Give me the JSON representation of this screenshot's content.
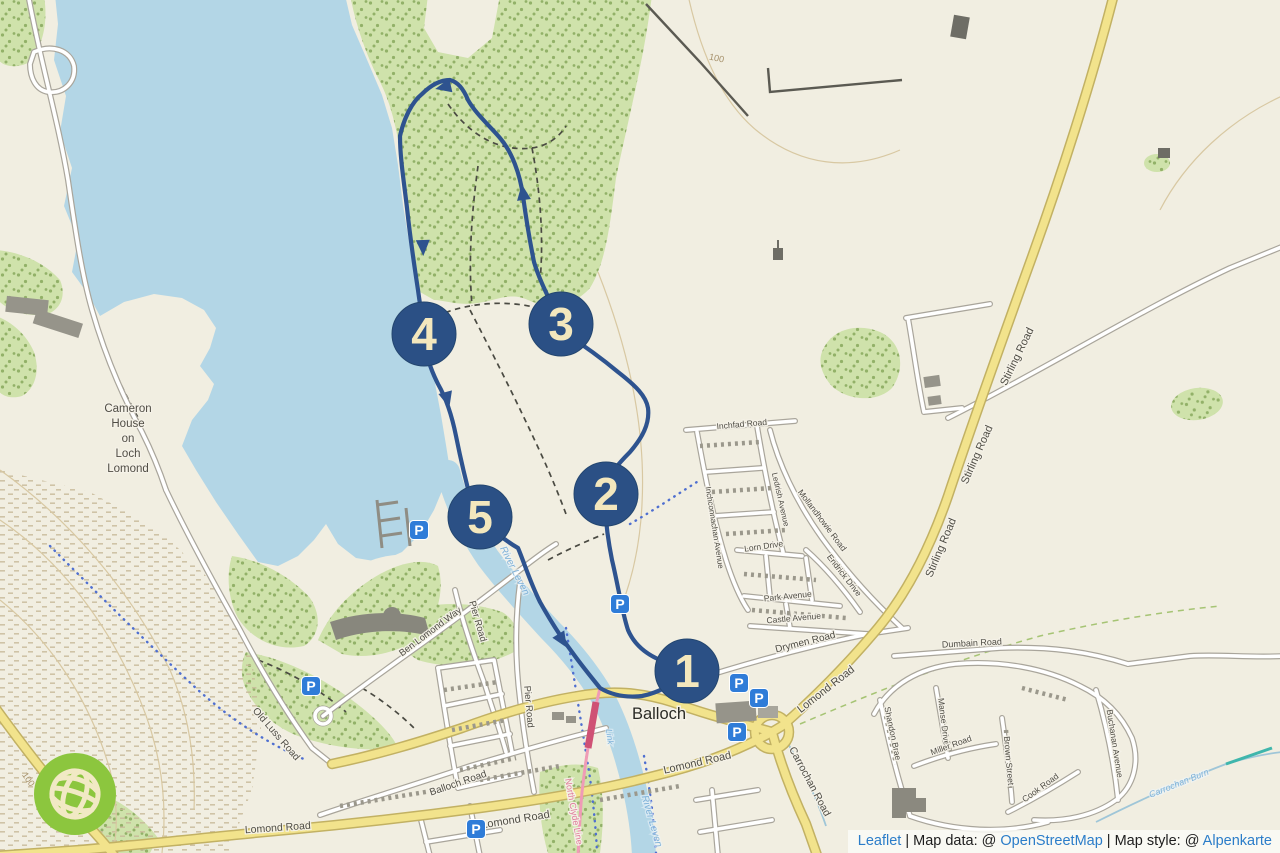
{
  "attribution": {
    "leaflet": "Leaflet",
    "sep1": " | Map data: @ ",
    "osm": "OpenStreetMap",
    "sep2": " | Map style: @ ",
    "style_name": "Alpenkarte"
  },
  "map": {
    "parking_letter": "P",
    "cameron_lines": [
      "Cameron",
      "House",
      "on",
      "Loch",
      "Lomond"
    ],
    "markers": [
      {
        "n": "1",
        "x": 687,
        "y": 671
      },
      {
        "n": "2",
        "x": 606,
        "y": 494
      },
      {
        "n": "3",
        "x": 561,
        "y": 324
      },
      {
        "n": "4",
        "x": 424,
        "y": 334
      },
      {
        "n": "5",
        "x": 480,
        "y": 517
      }
    ],
    "parking": [
      {
        "x": 419,
        "y": 530
      },
      {
        "x": 311,
        "y": 686
      },
      {
        "x": 476,
        "y": 829
      },
      {
        "x": 739,
        "y": 683
      },
      {
        "x": 759,
        "y": 698
      },
      {
        "x": 737,
        "y": 732
      },
      {
        "x": 620,
        "y": 604
      }
    ],
    "labels": [
      {
        "id": "balloch-town",
        "text": "Balloch",
        "x": 659,
        "y": 719,
        "rot": 0,
        "size": 16.5,
        "cls": "town"
      },
      {
        "id": "stirling-road-1",
        "text": "Stirling Road",
        "x": 1020,
        "y": 358,
        "rot": -64,
        "size": 11,
        "cls": "road"
      },
      {
        "id": "stirling-road-2",
        "text": "Stirling Road",
        "x": 980,
        "y": 456,
        "rot": -66,
        "size": 11,
        "cls": "road"
      },
      {
        "id": "stirling-road-3",
        "text": "Stirling Road",
        "x": 944,
        "y": 549,
        "rot": -67,
        "size": 11,
        "cls": "road"
      },
      {
        "id": "lomond-road-ne",
        "text": "Lomond Road",
        "x": 828,
        "y": 692,
        "rot": -38,
        "size": 11,
        "cls": "road"
      },
      {
        "id": "lomond-road-mid",
        "text": "Lomond Road",
        "x": 698,
        "y": 766,
        "rot": -13,
        "size": 11,
        "cls": "road"
      },
      {
        "id": "lomond-road-s",
        "text": "Lomond Road",
        "x": 516,
        "y": 823,
        "rot": -9,
        "size": 11,
        "cls": "road"
      },
      {
        "id": "lomond-road-sw",
        "text": "Lomond Road",
        "x": 278,
        "y": 831,
        "rot": -4,
        "size": 10.5,
        "cls": "road"
      },
      {
        "id": "drymen-road",
        "text": "Drymen Road",
        "x": 806,
        "y": 645,
        "rot": -14,
        "size": 10,
        "cls": "road"
      },
      {
        "id": "carrochan-road",
        "text": "Carrochan Road",
        "x": 807,
        "y": 783,
        "rot": 62,
        "size": 10.5,
        "cls": "road"
      },
      {
        "id": "balloch-road",
        "text": "Balloch Road",
        "x": 459,
        "y": 786,
        "rot": -19,
        "size": 10,
        "cls": "road"
      },
      {
        "id": "pier-road-a",
        "text": "Pier Road",
        "x": 475,
        "y": 622,
        "rot": 74,
        "size": 9.5,
        "cls": "road"
      },
      {
        "id": "pier-road-b",
        "text": "Pier Road",
        "x": 526,
        "y": 707,
        "rot": 85,
        "size": 9.5,
        "cls": "road"
      },
      {
        "id": "ben-lomond-way",
        "text": "Ben Lomond Way",
        "x": 432,
        "y": 634,
        "rot": -37,
        "size": 9.5,
        "cls": "road"
      },
      {
        "id": "old-luss-road",
        "text": "Old Luss Road",
        "x": 274,
        "y": 736,
        "rot": 49,
        "size": 10,
        "cls": "road"
      },
      {
        "id": "inchfad-road",
        "text": "Inchfad Road",
        "x": 742,
        "y": 427,
        "rot": -5,
        "size": 8.5,
        "cls": "road"
      },
      {
        "id": "inchconnachan-avenue",
        "text": "Inchconnachan Avenue",
        "x": 712,
        "y": 528,
        "rot": 81,
        "size": 8,
        "cls": "road"
      },
      {
        "id": "ledrish-avenue",
        "text": "Ledrish Avenue",
        "x": 778,
        "y": 500,
        "rot": 77,
        "size": 8,
        "cls": "road"
      },
      {
        "id": "mollandhowie-road",
        "text": "Mollandhowie Road",
        "x": 820,
        "y": 522,
        "rot": 53,
        "size": 8.5,
        "cls": "road"
      },
      {
        "id": "lorn-drive",
        "text": "Lorn Drive",
        "x": 764,
        "y": 549,
        "rot": -8,
        "size": 8.5,
        "cls": "road"
      },
      {
        "id": "endrick-drive",
        "text": "Endrick Drive",
        "x": 842,
        "y": 577,
        "rot": 52,
        "size": 8.5,
        "cls": "road"
      },
      {
        "id": "park-avenue",
        "text": "Park Avenue",
        "x": 788,
        "y": 599,
        "rot": -6,
        "size": 8.5,
        "cls": "road"
      },
      {
        "id": "castle-avenue",
        "text": "Castle Avenue",
        "x": 794,
        "y": 621,
        "rot": -5,
        "size": 8.5,
        "cls": "road"
      },
      {
        "id": "dumbain-road",
        "text": "Dumbain Road",
        "x": 972,
        "y": 646,
        "rot": -3,
        "size": 9,
        "cls": "road"
      },
      {
        "id": "shandon-brae",
        "text": "Shandon Brae",
        "x": 890,
        "y": 734,
        "rot": 78,
        "size": 8.5,
        "cls": "road"
      },
      {
        "id": "manse-drive",
        "text": "Manse Drive",
        "x": 941,
        "y": 722,
        "rot": 83,
        "size": 8.5,
        "cls": "road"
      },
      {
        "id": "miller-road",
        "text": "Miller Road",
        "x": 952,
        "y": 748,
        "rot": -20,
        "size": 8.5,
        "cls": "road"
      },
      {
        "id": "brown-street",
        "text": "Brown Street",
        "x": 1006,
        "y": 761,
        "rot": 85,
        "size": 8.5,
        "cls": "road"
      },
      {
        "id": "cook-road",
        "text": "Cook Road",
        "x": 1042,
        "y": 790,
        "rot": -36,
        "size": 8.5,
        "cls": "road"
      },
      {
        "id": "buchanan-avenue",
        "text": "Buchanan Avenue",
        "x": 1112,
        "y": 744,
        "rot": 81,
        "size": 8.5,
        "cls": "road"
      },
      {
        "id": "river-leven-upper",
        "text": "River Leven",
        "x": 512,
        "y": 572,
        "rot": 63,
        "size": 10,
        "cls": "water"
      },
      {
        "id": "river-leven-lower",
        "text": "River Leven",
        "x": 649,
        "y": 822,
        "rot": 74,
        "size": 10,
        "cls": "water"
      },
      {
        "id": "link-path",
        "text": "Link",
        "x": 607,
        "y": 737,
        "rot": 84,
        "size": 8.5,
        "cls": "water"
      },
      {
        "id": "carrochan-burn",
        "text": "Carrochan Burn",
        "x": 1180,
        "y": 786,
        "rot": -22,
        "size": 9,
        "cls": "water"
      },
      {
        "id": "north-clyde-line",
        "text": "North Clyde Line",
        "x": 571,
        "y": 812,
        "rot": 80,
        "size": 9,
        "cls": "rail"
      },
      {
        "id": "contour-100-sw",
        "text": "100",
        "x": 26,
        "y": 781,
        "rot": 55,
        "size": 9,
        "cls": "contour"
      },
      {
        "id": "contour-100-ne",
        "text": "100",
        "x": 716,
        "y": 61,
        "rot": 12,
        "size": 9,
        "cls": "contour"
      }
    ],
    "colors": {
      "water": "#b3d6e6",
      "forest": "#cfe2ab",
      "land": "#f1eee1",
      "primary_road": "#f2e38c",
      "route": "#2e538f",
      "marker": "#2b5085",
      "marker_text": "#f3e7bd",
      "parking": "#2f7cd8",
      "railway": "#ef9bb6",
      "logo_green": "#8cc63e",
      "link_blue": "#2b7dc9"
    }
  }
}
